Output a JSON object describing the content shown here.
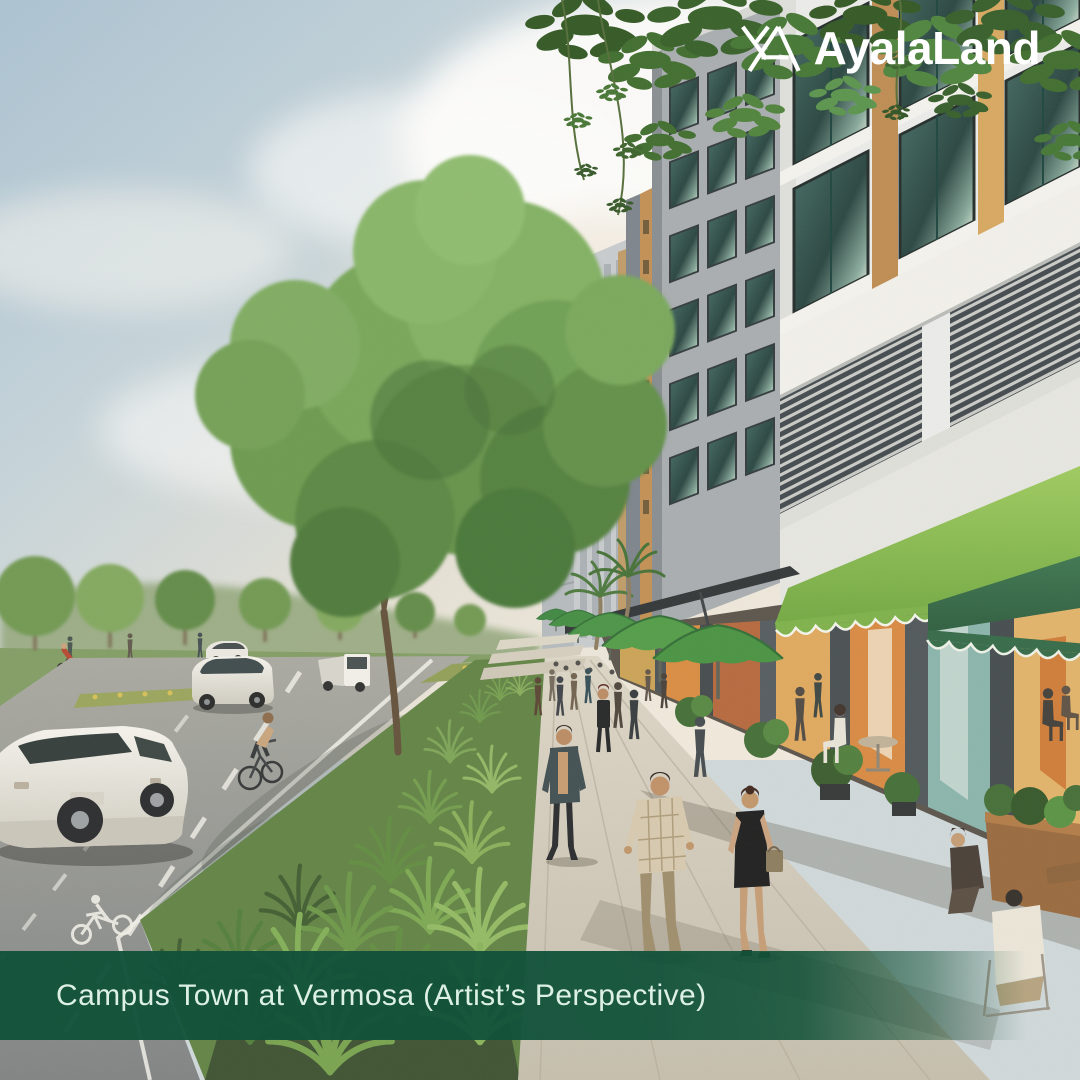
{
  "brand": {
    "logo_text": "AyalaLand",
    "logo_mark": "ayalaland-monogram-icon",
    "color": "#ffffff"
  },
  "caption": {
    "text": "Campus Town at Vermosa (Artist’s Perspective)",
    "bar_color": "#125239",
    "text_color": "#ddf0e4"
  },
  "scene": {
    "kind": "architects-perspective-rendering",
    "elements": [
      "sky with clouds",
      "park treeline",
      "boulevard with bike lane and bike-lane marking",
      "white suv",
      "white sedan",
      "white van",
      "cyclist",
      "flower median",
      "shrub bed",
      "large tree",
      "pedestrian promenade with walkers",
      "green cafe umbrellas",
      "light and dark green scalloped awnings",
      "storefronts with warm posters",
      "cafe seating with diners",
      "mid-rise buildings with amber accents and louvers",
      "overhanging foliage"
    ],
    "palette": {
      "sky_blue": "#a9c2d4",
      "cloud_white": "#f4efe6",
      "tree_green": "#73a557",
      "shrub_green": "#6f9b4a",
      "road_gray": "#8a8d8b",
      "pavement_tan": "#d2ccbe",
      "building_white": "#eceded",
      "building_gray": "#a6acb1",
      "accent_amber": "#d7a75e",
      "glass_teal": "#2e5452",
      "awning_light_green": "#7ab148",
      "awning_dark_green": "#2e6745",
      "umbrella_green": "#4d9b45",
      "banner_green": "#125239"
    }
  }
}
